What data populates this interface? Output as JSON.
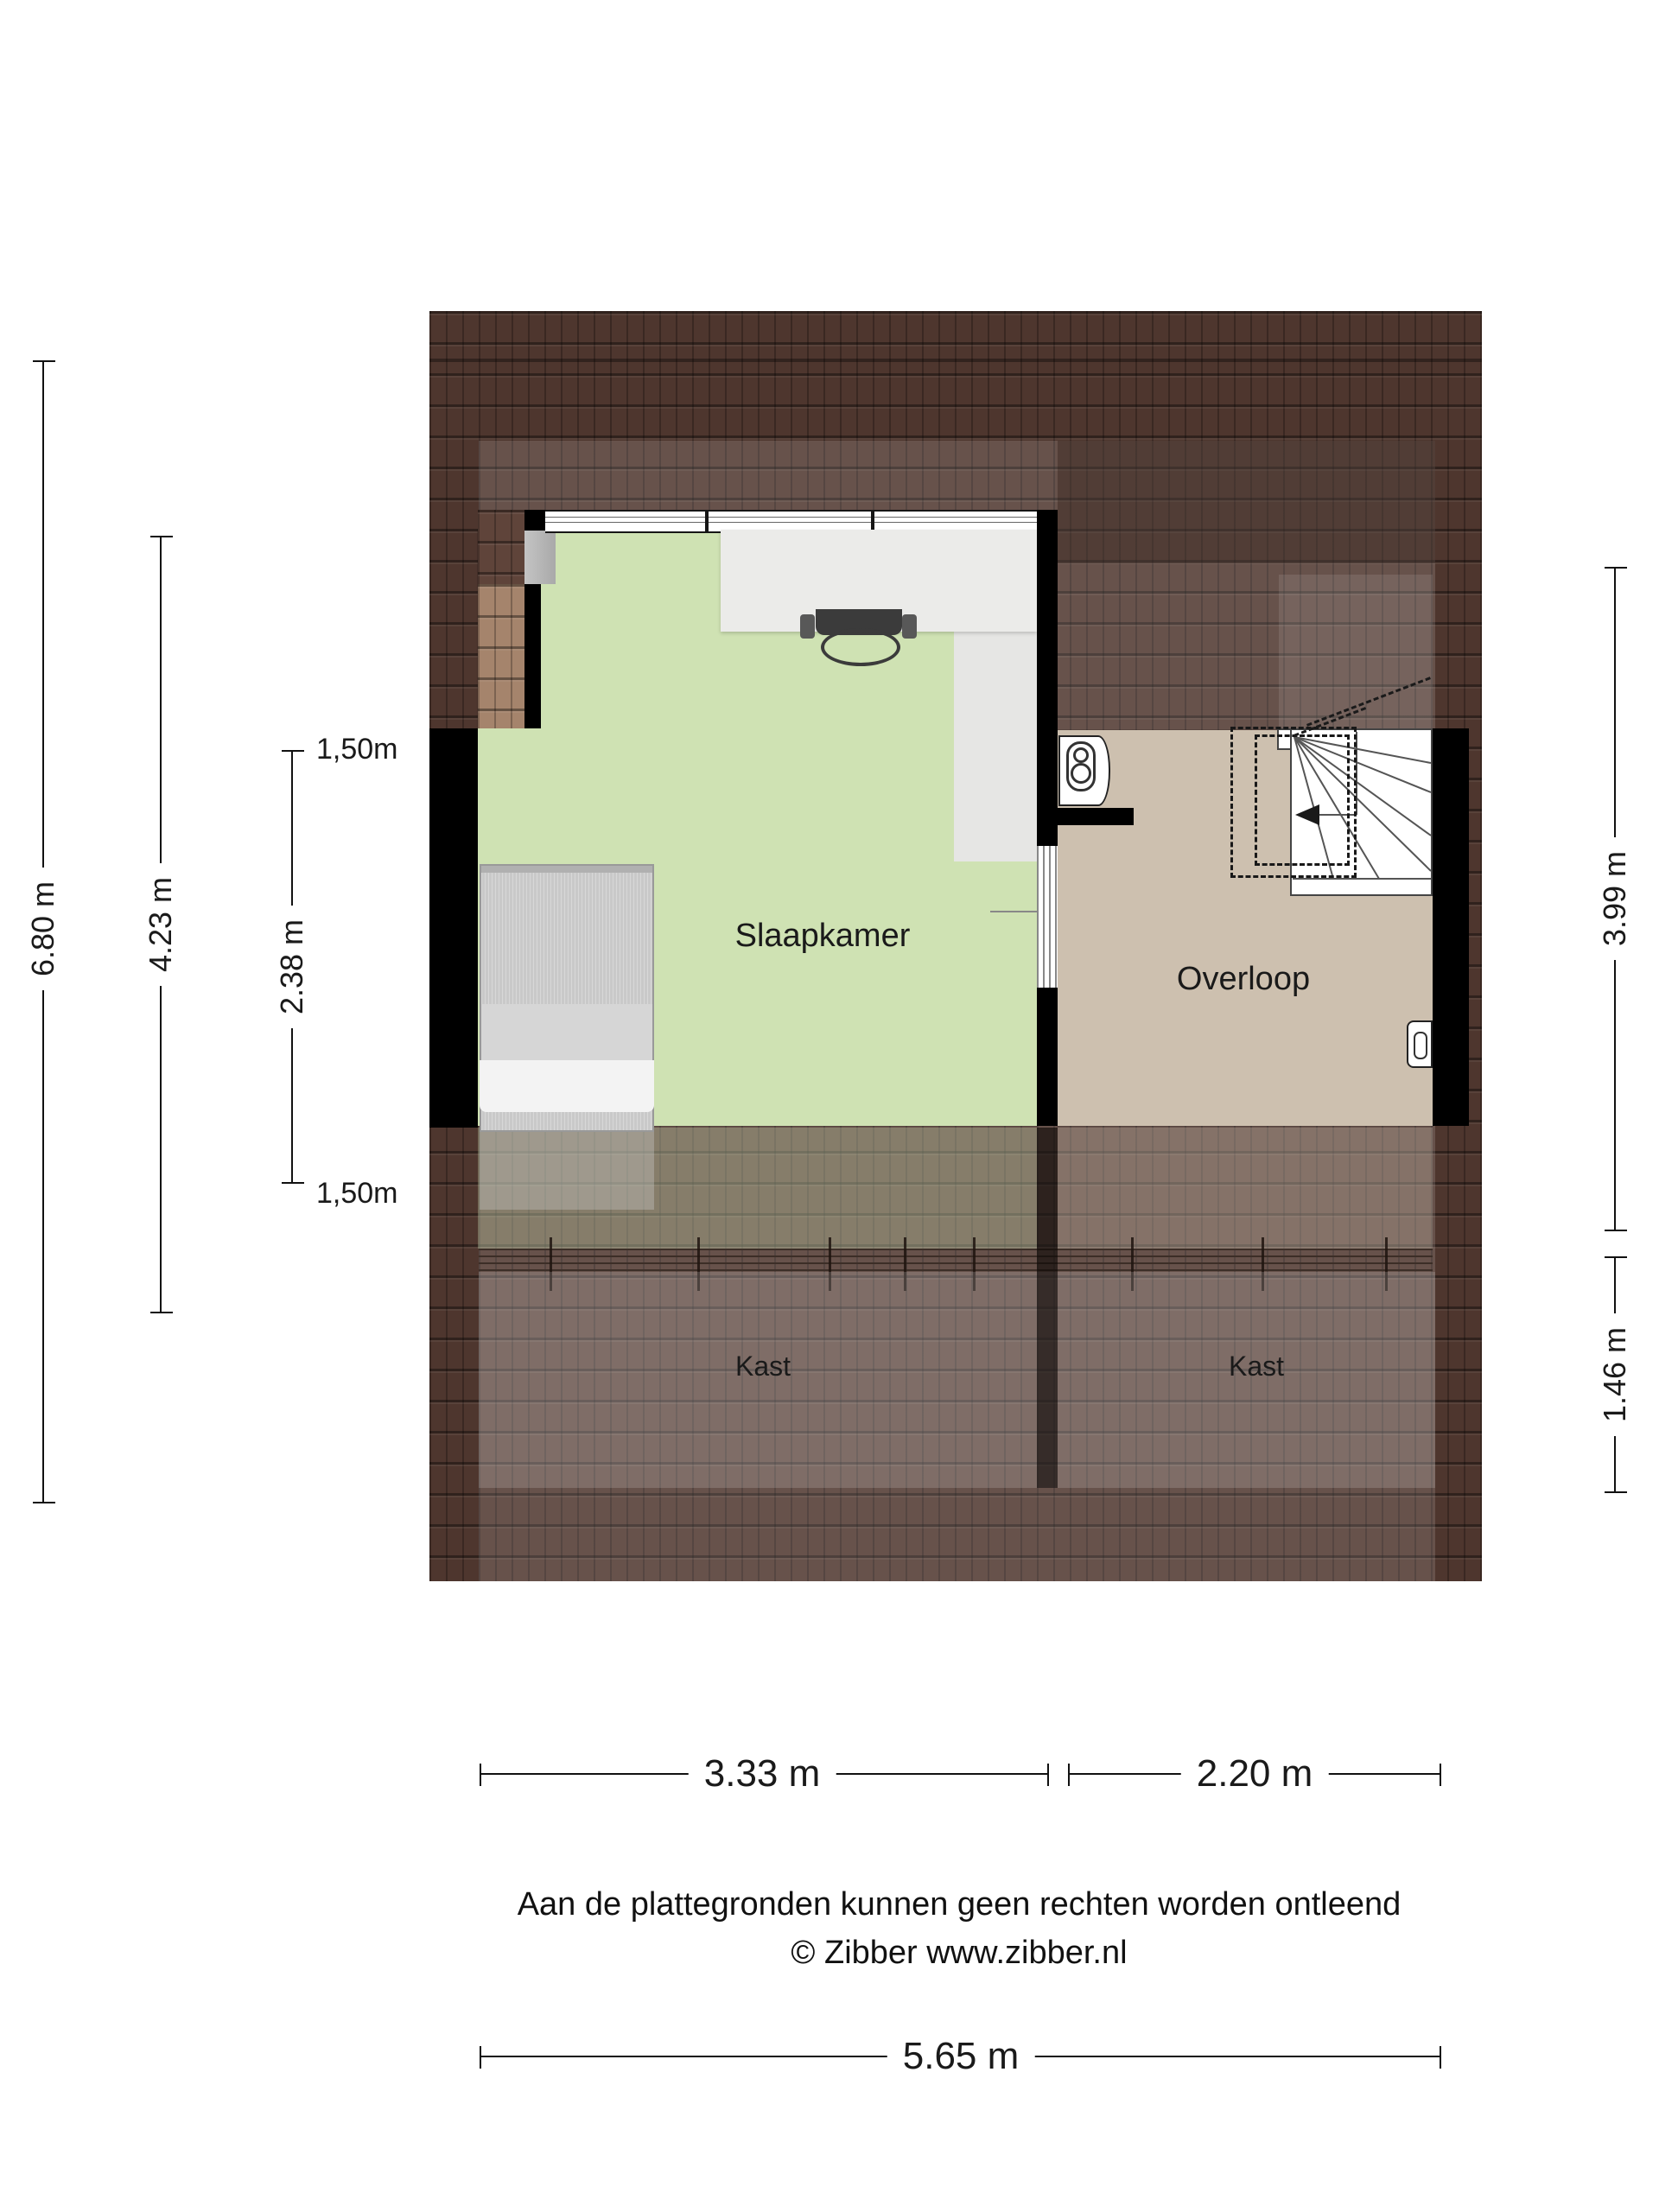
{
  "floorplan": {
    "room_labels": {
      "slaapkamer": "Slaapkamer",
      "overloop": "Overloop",
      "kast_left": "Kast",
      "kast_right": "Kast"
    },
    "dimensions": {
      "left_outer": "6.80 m",
      "left_middle": "4.23 m",
      "left_inner": "2.38 m",
      "ceiling_marker_top": "1,50m",
      "ceiling_marker_bottom": "1,50m",
      "right_upper": "3.99 m",
      "right_lower": "1.46 m",
      "bottom_left": "3.33 m",
      "bottom_right": "2.20 m",
      "bottom_total": "5.65 m"
    }
  },
  "footer": {
    "disclaimer": "Aan de plattegronden kunnen geen rechten worden ontleend",
    "copyright": "© Zibber www.zibber.nl"
  },
  "colors": {
    "floor-green": "#cfe2b3",
    "floor-tan": "#cdc0af",
    "roof-dark": "#4e362e",
    "roof-strip-dark": "#5f443a",
    "roof-strip-light": "#a5846c",
    "wall-black": "#000000",
    "desk-gray": "#ebebe9",
    "bed-gray": "#c9c9c9",
    "text-dark": "#1a1a1a"
  }
}
